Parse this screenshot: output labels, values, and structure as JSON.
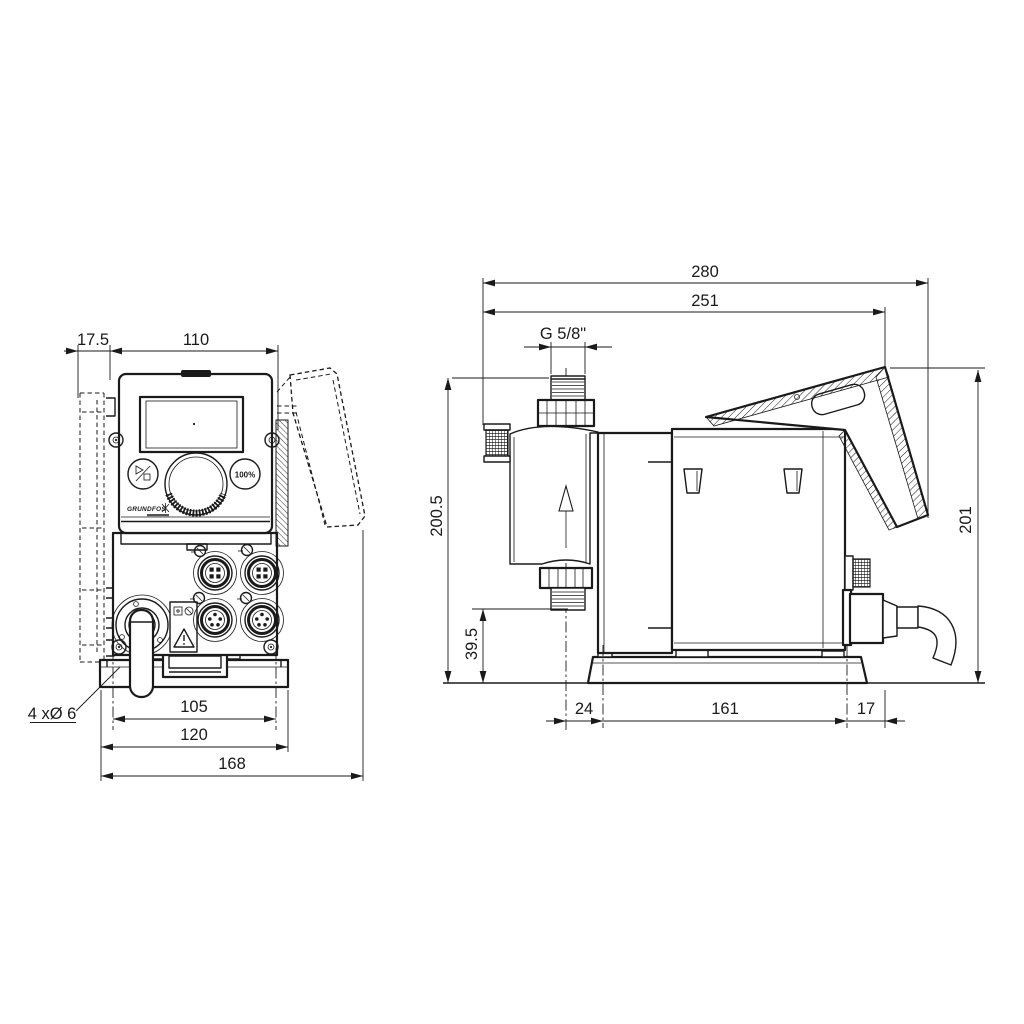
{
  "drawing": {
    "front_view": {
      "dimensions": {
        "plate_offset": "17.5",
        "housing_width": "110",
        "hole_spacing": "105",
        "plate_width": "120",
        "total_width": "168",
        "holes_note": "4 xØ 6"
      },
      "panel": {
        "logo": "GRUNDFOS",
        "button_right_label": "100%"
      }
    },
    "side_view": {
      "dimensions": {
        "total_depth": "280",
        "body_depth": "251",
        "thread": "G 5/8\"",
        "height_to_connector": "200.5",
        "connector_clearance": "39.5",
        "head_to_hole": "24",
        "hole_spacing": "161",
        "rear_offset": "17",
        "total_height": "201"
      }
    }
  }
}
